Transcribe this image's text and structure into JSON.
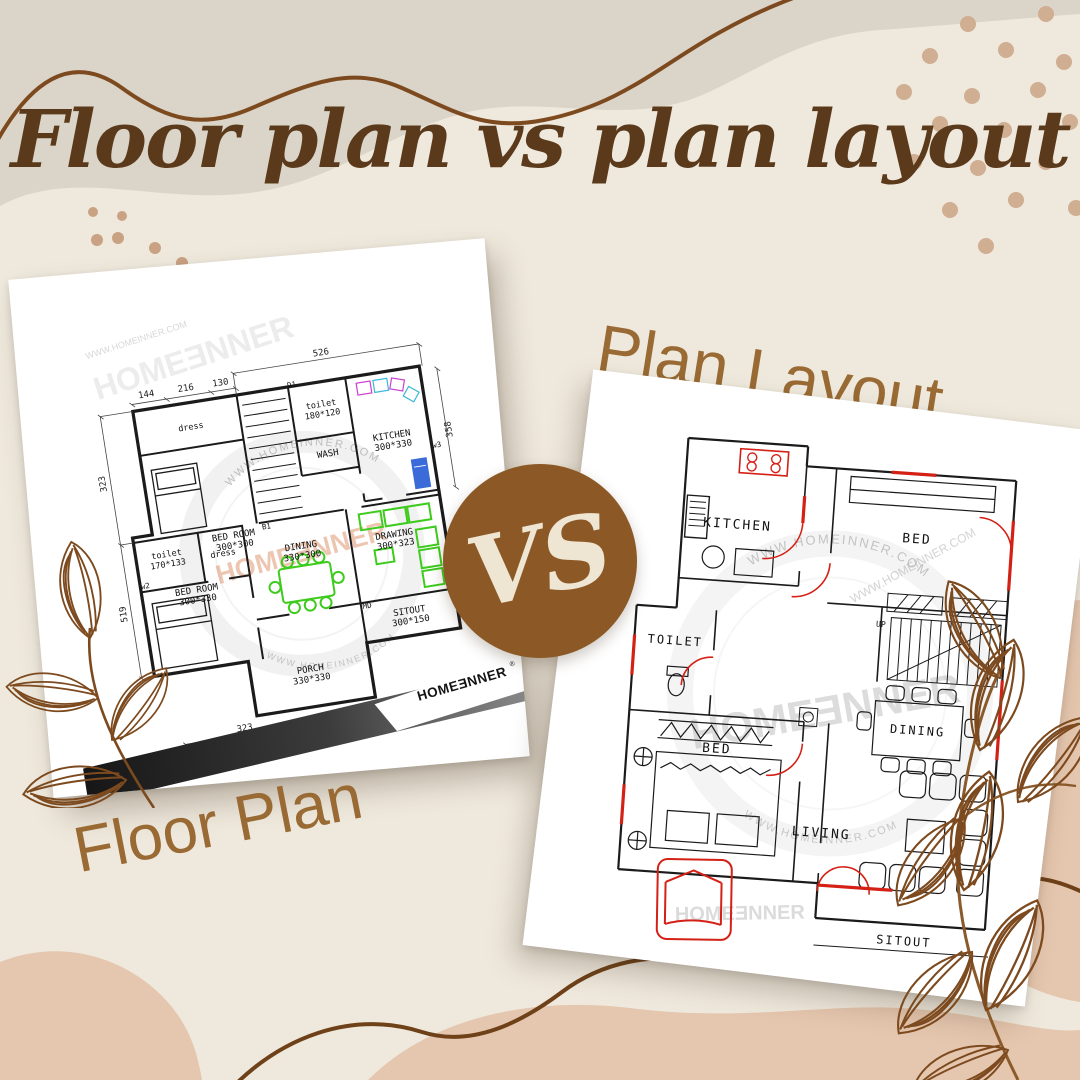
{
  "page": {
    "title": "Floor plan vs plan layout"
  },
  "captions": {
    "floor_plan": "Floor Plan",
    "plan_layout": "Plan Layout"
  },
  "vs_badge": {
    "label": "VS"
  },
  "brand": {
    "logo_text": "HOMEƎNNER",
    "registered_mark": "®",
    "website": "WWW.HOMEINNER.COM"
  },
  "floor_plan": {
    "rooms": {
      "dress_top": {
        "name": "dress",
        "dims": ""
      },
      "bedroom_top": {
        "name": "BED ROOM",
        "dims": "300*300"
      },
      "toilet_top": {
        "name": "toilet",
        "dims": "180*120"
      },
      "wash": {
        "name": "WASH",
        "dims": ""
      },
      "kitchen": {
        "name": "KITCHEN",
        "dims": "300*330"
      },
      "toilet_mid": {
        "name": "toilet",
        "dims": "170*133"
      },
      "dress_mid": {
        "name": "dress",
        "dims": ""
      },
      "bedroom_bottom": {
        "name": "BED ROOM",
        "dims": "300*330"
      },
      "dining": {
        "name": "DINING",
        "dims": "330*300"
      },
      "drawing": {
        "name": "DRAWING",
        "dims": "300*323"
      },
      "sitout": {
        "name": "SITOUT",
        "dims": "300*150"
      },
      "porch": {
        "name": "PORCH",
        "dims": "330*330"
      }
    },
    "dims": {
      "top": "526",
      "seg1": "144",
      "seg2": "216",
      "seg3": "130",
      "left_upper": "323",
      "left_lower": "519",
      "right": "358",
      "bottom1": "323",
      "bottom2": "376",
      "bottom3": "323"
    },
    "tags": {
      "d1": "D1",
      "b1": "B1",
      "w2": "w2",
      "w3": "w3",
      "md": "MD"
    }
  },
  "plan_layout": {
    "rooms": {
      "kitchen": "KITCHEN",
      "bed_top": "BED",
      "toilet": "TOILET",
      "bed_bottom": "BED",
      "dining": "DINING",
      "living": "LIVING",
      "sitout": "SITOUT"
    },
    "stairs": "UP"
  },
  "colors": {
    "background": "#EFE9DD",
    "blob_taupe": "#DBD5C9",
    "blob_peach": "#E5C6AE",
    "line_brown": "#7C4A1E",
    "dot_tan": "#D0AE92",
    "title_brown": "#5B3A1C",
    "caption_brown": "#996A33",
    "badge_brown": "#8C5926",
    "badge_text": "#EEE5D3",
    "plan_green": "#3ECB1E",
    "plan_blue": "#3A6BD8",
    "plan_red": "#D42015"
  }
}
